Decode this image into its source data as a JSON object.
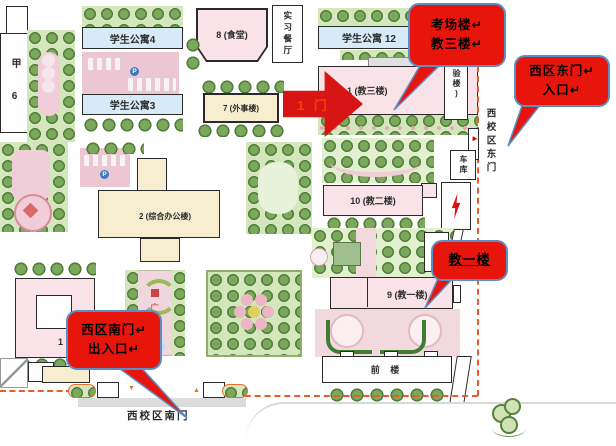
{
  "callouts": {
    "exam_building": {
      "line1": "考场楼↵",
      "line2": "教三楼↵"
    },
    "east_gate": {
      "line1": "西区东门↵",
      "line2": "入口↵"
    },
    "teach_one_building": {
      "line1": "教一楼"
    },
    "south_gate": {
      "line1": "西区南门↵",
      "line2": "出入口↵"
    }
  },
  "annotations": {
    "gate1_arrow_label": "1 门"
  },
  "buildings": {
    "student_apartment_4": "学生公寓4",
    "student_apartment_3": "学生公寓3",
    "student_apartment_12": "学生公寓 12",
    "canteen": "8 (食堂)",
    "practice_restaurant": "实习餐厅",
    "foreign_affairs": "7 (外事楼)",
    "teaching_3": "1 (教三楼)",
    "lab": "(实验楼)",
    "admin": "2 (综合办公楼)",
    "teaching_2": "10 (教二楼)",
    "teaching_1": "9 (教一楼)",
    "garage": "车库",
    "front_building": "前 楼",
    "jia_6": "甲 6",
    "building_1": "1 (",
    "plaza": "广场"
  },
  "map_labels": {
    "east_gate_vertical": "西校区东门",
    "south_gate": "西校区南门",
    "parking_p": "P"
  },
  "icons": {
    "east_gate_marker": "►",
    "south_gate_down_marker": "▼",
    "south_gate_up_marker": "▲"
  },
  "colors": {
    "callout_red": "#e8150d",
    "callout_border": "#5b8ec4",
    "arrow_red": "#d81515",
    "arrow_label_red": "#ff3d00",
    "boundary_dashed": "#ea5a2b"
  }
}
